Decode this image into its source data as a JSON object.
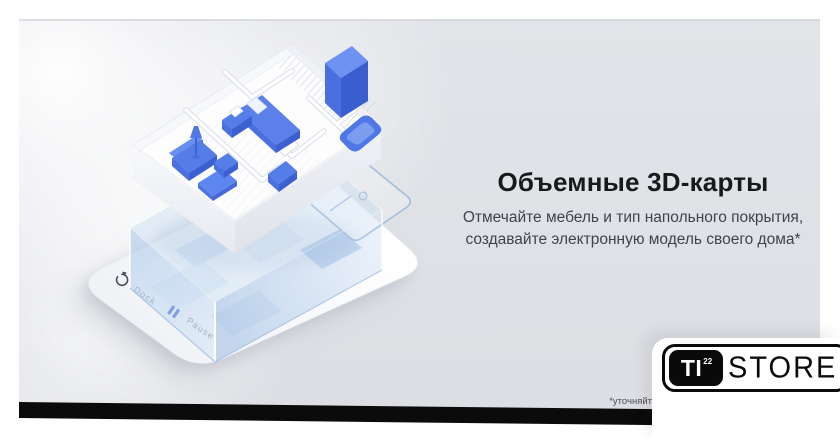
{
  "banner": {
    "heading": "Объемные 3D-карты",
    "description_line1": "Отмечайте мебель и тип напольного покрытия,",
    "description_line2": "создавайте электронную модель своего дома*",
    "footnote": "*уточняйт"
  },
  "device_ui": {
    "dock_label": "Dock",
    "pause_label": "Pause",
    "icons": {
      "dock": "dock-recharge-icon",
      "pause": "pause-icon"
    }
  },
  "logo": {
    "ti": "TI",
    "sup": "22",
    "store": "STORE"
  },
  "colors": {
    "banner_bg": "#dfe1e6",
    "accent_blue": "#4a72e0",
    "furniture_blue_light": "#5b80e9",
    "furniture_blue_dark": "#3c5fd2",
    "glass_blue": "#aecbe9",
    "heading_text": "#18191b",
    "body_text": "#3f434c",
    "label_gray": "#8e939d",
    "logo_black": "#0a0a0a",
    "strip_black": "#0b0b0c"
  }
}
